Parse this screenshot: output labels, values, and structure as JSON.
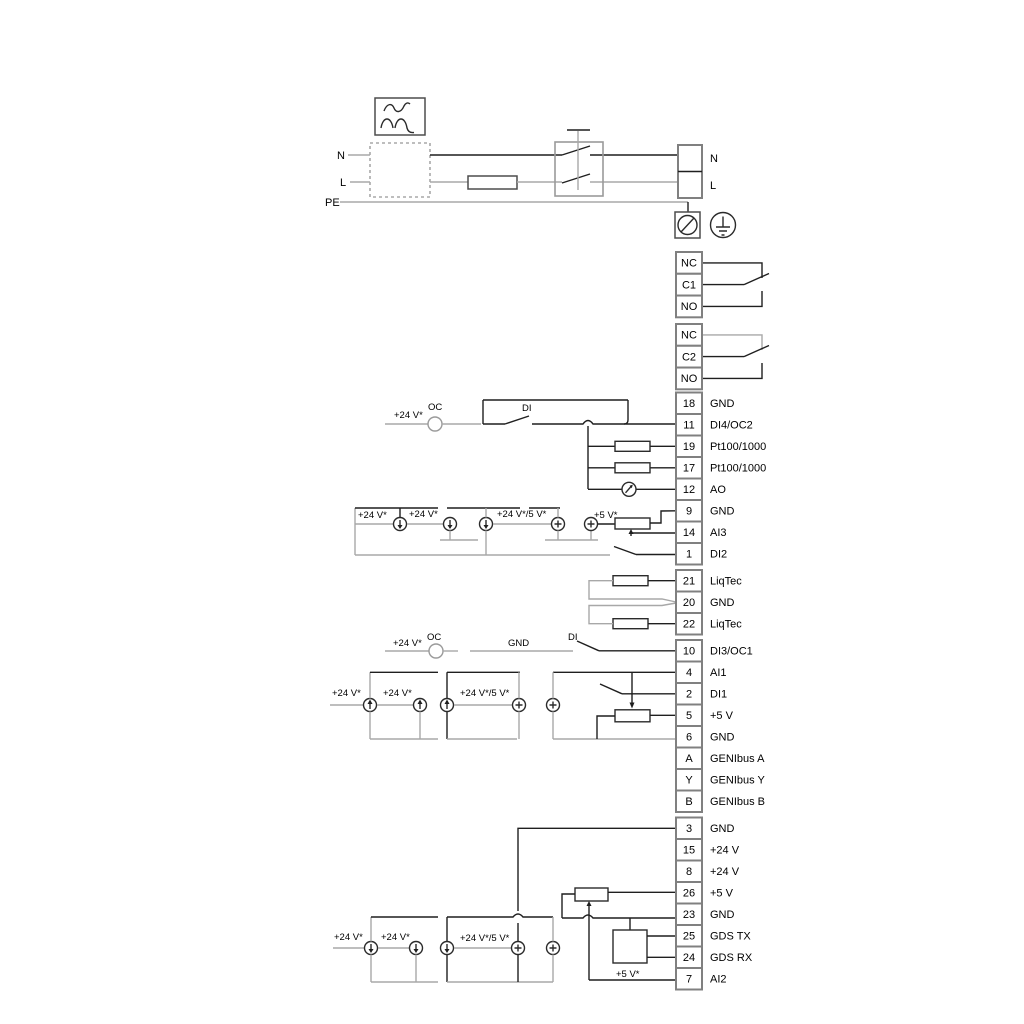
{
  "colors": {
    "wire_dark": "#1f1f1f",
    "wire_gray": "#a8a8a8",
    "terminal_border": "#808080",
    "text": "#000000",
    "background": "#ffffff"
  },
  "power_section": {
    "n_left": "N",
    "l_left": "L",
    "pe": "PE",
    "n_right": "N",
    "l_right": "L"
  },
  "relays": [
    {
      "terminals": [
        "NC",
        "C1",
        "NO"
      ]
    },
    {
      "terminals": [
        "NC",
        "C2",
        "NO"
      ]
    }
  ],
  "terminal_blocks": [
    {
      "id": "io1",
      "rows": [
        {
          "n": "18",
          "label": "GND"
        },
        {
          "n": "11",
          "label": "DI4/OC2"
        },
        {
          "n": "19",
          "label": "Pt100/1000"
        },
        {
          "n": "17",
          "label": "Pt100/1000"
        },
        {
          "n": "12",
          "label": "AO"
        },
        {
          "n": "9",
          "label": "GND"
        },
        {
          "n": "14",
          "label": "AI3"
        },
        {
          "n": "1",
          "label": "DI2"
        }
      ]
    },
    {
      "id": "liqtec",
      "rows": [
        {
          "n": "21",
          "label": "LiqTec"
        },
        {
          "n": "20",
          "label": "GND"
        },
        {
          "n": "22",
          "label": "LiqTec"
        }
      ]
    },
    {
      "id": "io2",
      "rows": [
        {
          "n": "10",
          "label": "DI3/OC1"
        },
        {
          "n": "4",
          "label": "AI1"
        },
        {
          "n": "2",
          "label": "DI1"
        },
        {
          "n": "5",
          "label": "+5 V"
        },
        {
          "n": "6",
          "label": "GND"
        },
        {
          "n": "A",
          "label": "GENIbus A"
        },
        {
          "n": "Y",
          "label": "GENIbus Y"
        },
        {
          "n": "B",
          "label": "GENIbus B"
        }
      ]
    },
    {
      "id": "io3",
      "rows": [
        {
          "n": "3",
          "label": "GND"
        },
        {
          "n": "15",
          "label": "+24 V"
        },
        {
          "n": "8",
          "label": "+24 V"
        },
        {
          "n": "26",
          "label": "+5 V"
        },
        {
          "n": "23",
          "label": "GND"
        },
        {
          "n": "25",
          "label": "GDS TX"
        },
        {
          "n": "24",
          "label": "GDS RX"
        },
        {
          "n": "7",
          "label": "AI2"
        }
      ]
    }
  ],
  "annotations": [
    {
      "id": "pow_n_left",
      "text": "N"
    },
    {
      "id": "pow_l_left",
      "text": "L"
    },
    {
      "id": "pow_pe",
      "text": "PE"
    },
    {
      "id": "pow_n_right",
      "text": "N"
    },
    {
      "id": "pow_l_right",
      "text": "L"
    },
    {
      "id": "di4_v24",
      "text": "+24 V*"
    },
    {
      "id": "di4_oc",
      "text": "OC"
    },
    {
      "id": "di4_di",
      "text": "DI"
    },
    {
      "id": "ai3_v24_1",
      "text": "+24 V*"
    },
    {
      "id": "ai3_v24_2",
      "text": "+24 V*"
    },
    {
      "id": "ai3_v24_5",
      "text": "+24 V*/5 V*"
    },
    {
      "id": "ai3_v5",
      "text": "+5 V*"
    },
    {
      "id": "di3_v24",
      "text": "+24 V*"
    },
    {
      "id": "di3_oc",
      "text": "OC"
    },
    {
      "id": "di3_gnd",
      "text": "GND"
    },
    {
      "id": "di3_di",
      "text": "DI"
    },
    {
      "id": "ai1_v24_1",
      "text": "+24 V*"
    },
    {
      "id": "ai1_v24_2",
      "text": "+24 V*"
    },
    {
      "id": "ai1_v24_5",
      "text": "+24 V*/5 V*"
    },
    {
      "id": "ai2_v24_1",
      "text": "+24 V*"
    },
    {
      "id": "ai2_v24_2",
      "text": "+24 V*"
    },
    {
      "id": "ai2_v24_5",
      "text": "+24 V*/5 V*"
    },
    {
      "id": "ai2_v5",
      "text": "+5 V*"
    }
  ]
}
